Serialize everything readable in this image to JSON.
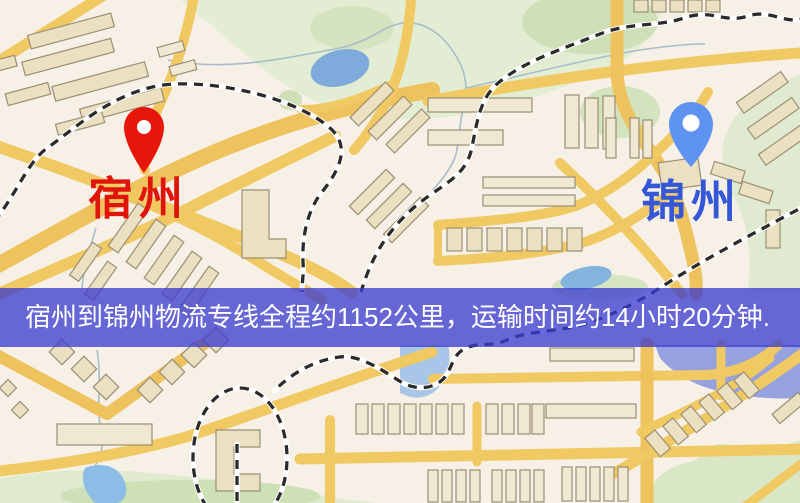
{
  "map": {
    "origin": {
      "label": "宿州",
      "pin_icon": "map-pin",
      "pin_color": "#e8150b",
      "label_color": "#e0150a"
    },
    "destination": {
      "label": "锦州",
      "pin_icon": "map-pin",
      "pin_color": "#5f93f2",
      "label_color": "#3457d5"
    }
  },
  "banner": {
    "text": "宿州到锦州物流专线全程约1152公里，运输时间约14小时20分钟.",
    "background_color": "rgba(56,58,208,0.76)",
    "text_color": "#ffffff"
  }
}
